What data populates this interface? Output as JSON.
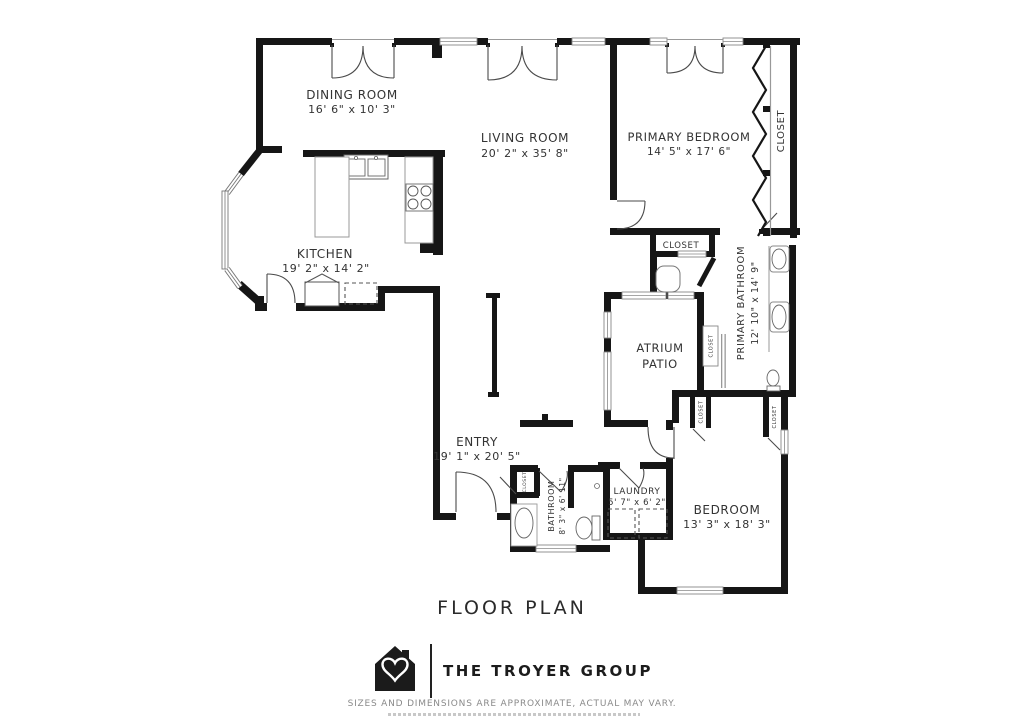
{
  "title": "FLOOR PLAN",
  "branding": {
    "company": "THE TROYER GROUP",
    "disclaimer": "SIZES AND DIMENSIONS ARE APPROXIMATE, ACTUAL MAY VARY."
  },
  "colors": {
    "wall": "#161616",
    "label": "#333333",
    "door": "#4a4a4a",
    "disclaimer": "#8a8a8a"
  },
  "rooms": {
    "dining": {
      "name": "DINING ROOM",
      "dims": "16' 6\" x 10' 3\""
    },
    "living": {
      "name": "LIVING ROOM",
      "dims": "20' 2\" x 35' 8\""
    },
    "primary_bedroom": {
      "name": "PRIMARY BEDROOM",
      "dims": "14' 5\" x 17' 6\""
    },
    "primary_closet": {
      "name": "CLOSET"
    },
    "kitchen": {
      "name": "KITCHEN",
      "dims": "19' 2\" x 14' 2\""
    },
    "hall_closet": {
      "name": "CLOSET"
    },
    "primary_bathroom": {
      "name": "PRIMARY BATHROOM",
      "dims": "12' 10\" x 14' 9\""
    },
    "atrium_patio": {
      "line1": "ATRIUM",
      "line2": "PATIO"
    },
    "entry": {
      "name": "ENTRY",
      "dims": "19' 1\" x 20' 5\""
    },
    "bathroom": {
      "name": "BATHROOM",
      "dims": "8' 3\" x 6' 11\""
    },
    "laundry": {
      "name": "LAUNDRY",
      "dims": "5' 7\" x 6' 2\""
    },
    "bedroom": {
      "name": "BEDROOM",
      "dims": "13' 3\" x 18' 3\""
    },
    "mini_closet_atrium": {
      "name": "CLOSET"
    },
    "mini_closet_a": {
      "name": "CLOSET"
    },
    "mini_closet_b": {
      "name": "CLOSET"
    },
    "mini_closet_bath": {
      "name": "CLOSET"
    }
  }
}
